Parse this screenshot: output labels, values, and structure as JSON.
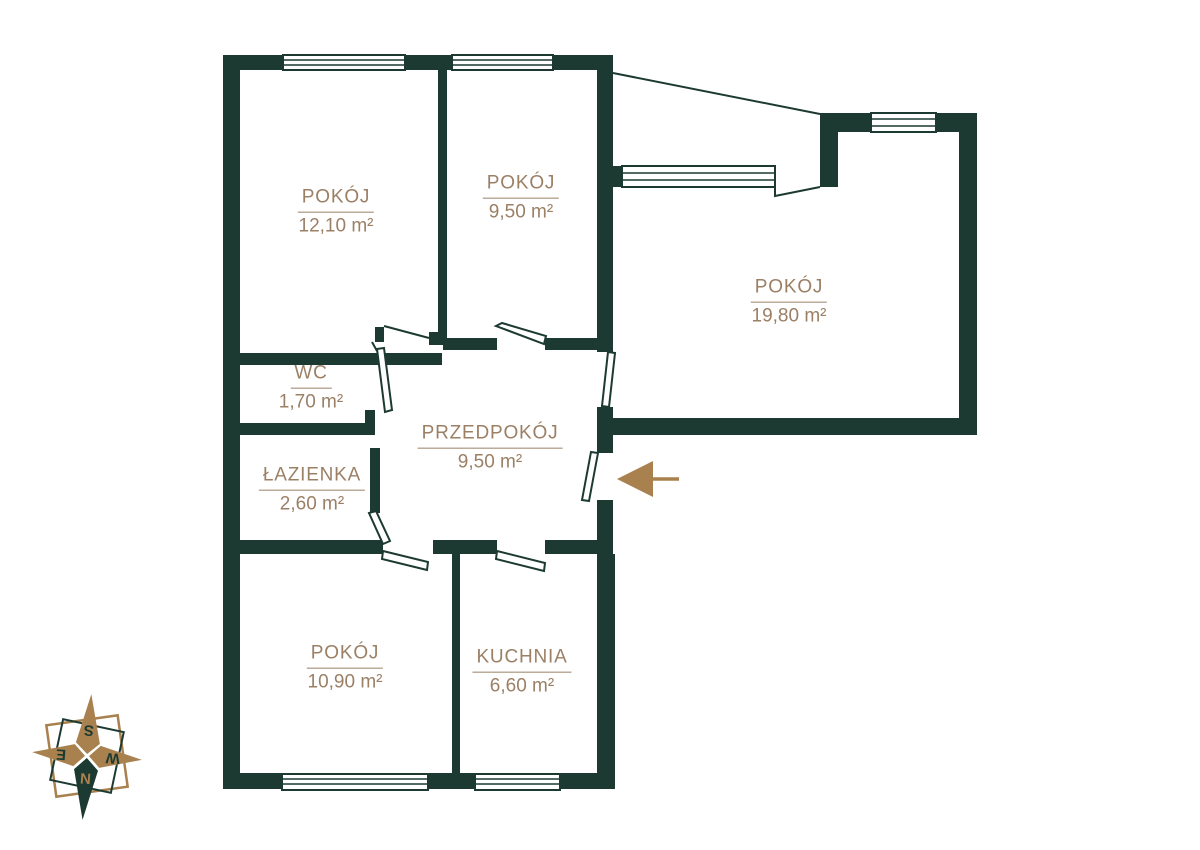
{
  "floor_plan": {
    "rooms": [
      {
        "name": "POKÓJ",
        "area": "12,10 m²"
      },
      {
        "name": "POKÓJ",
        "area": "9,50 m²"
      },
      {
        "name": "POKÓJ",
        "area": "19,80 m²"
      },
      {
        "name": "WC",
        "area": "1,70 m²"
      },
      {
        "name": "ŁAZIENKA",
        "area": "2,60 m²"
      },
      {
        "name": "PRZEDPOKÓJ",
        "area": "9,50 m²"
      },
      {
        "name": "POKÓJ",
        "area": "10,90 m²"
      },
      {
        "name": "KUCHNIA",
        "area": "6,60 m²"
      }
    ],
    "compass": {
      "n": "N",
      "s": "S",
      "e": "E",
      "w": "W"
    },
    "colors": {
      "wall": "#1c3a32",
      "label_text": "#9b8066",
      "accent_brown": "#a8814e"
    }
  }
}
